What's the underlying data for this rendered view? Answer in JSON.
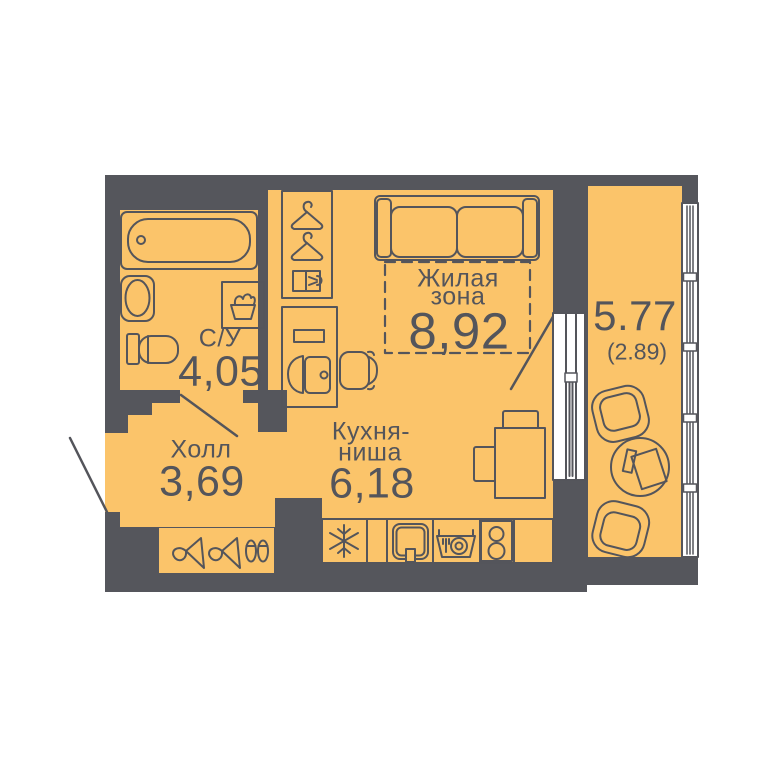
{
  "plan": {
    "type": "studio-apartment-floor-plan",
    "colors": {
      "floor": "#fbc46a",
      "wall": "#55565c",
      "line": "#54555b",
      "window_frame": "#ffffff",
      "background": "#ffffff"
    },
    "rooms": {
      "bathroom": {
        "name": "С/У",
        "area": "4,05"
      },
      "hall": {
        "name": "Холл",
        "area": "3,69"
      },
      "kitchen": {
        "name_line1": "Кухня-",
        "name_line2": "ниша",
        "area": "6,18"
      },
      "living": {
        "name_line1": "Жилая",
        "name_line2": "зона",
        "area": "8,92"
      },
      "balcony": {
        "area": "5.77",
        "area_secondary": "(2.89)"
      }
    },
    "fixtures": {
      "bathroom": [
        "bathtub",
        "sink",
        "toilet",
        "washing-machine-basket"
      ],
      "wardrobe": [
        "hanger",
        "hanger",
        "folded-clothes"
      ],
      "desk_nook": [
        "desk",
        "laptop",
        "chair"
      ],
      "living": [
        "sofa",
        "dashed-living-zone"
      ],
      "kitchen": [
        "fridge-snowflake",
        "kitchen-sink",
        "dishwasher-dishes",
        "stove-two-burner",
        "dining-table",
        "two-chairs"
      ],
      "hall_closet": [
        "side-hanger",
        "side-hanger",
        "shoes"
      ],
      "balcony": [
        "armchair",
        "round-table-with-papers",
        "armchair"
      ]
    },
    "doors": [
      "entrance-door-swing",
      "bathroom-door-swing",
      "balcony-door-swing"
    ],
    "windows": [
      "balcony-door-window-unit",
      "balcony-glazing"
    ]
  }
}
